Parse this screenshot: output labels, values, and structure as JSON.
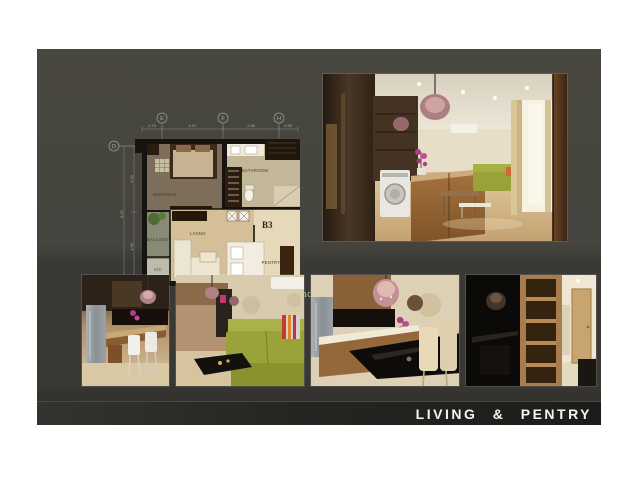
{
  "slide": {
    "footer_title": "LIVING  &  PENTRY"
  },
  "floorplan": {
    "caption": "RHYTHM Ratchada Condo",
    "unit_label": "B3",
    "grid_letters": {
      "top": [
        "E",
        "F",
        "H"
      ],
      "left": [
        "D",
        "C"
      ]
    },
    "dimensions": {
      "top": [
        "0.75",
        "3.10",
        "2.85",
        "0.95"
      ],
      "left": [
        "3.50",
        "1.95"
      ],
      "left_total": "6.45"
    },
    "rooms": {
      "bedroom": "BEDROOM",
      "bathroom": "BATHROOM",
      "living": "LIVING",
      "balcony": "BALCONY",
      "ac": "A/C",
      "pantry": "PENTRY"
    }
  },
  "photos": {
    "main": {
      "description": "Living room with wooden kitchen island, washing machine, crystal chandelier, green sofa, curtains and wood floor"
    },
    "thumbs": [
      {
        "description": "Kitchen bar with steel refrigerator, wooden counter and two white dining chairs"
      },
      {
        "description": "Living room with green sofa, striped cushions, black coffee table and air conditioner"
      },
      {
        "description": "Breakfast bar with chandelier, orchid flowers, black counter and cream chairs"
      },
      {
        "description": "Dark kitchen reflection, built-in wooden shelving and bright entrance hallway"
      }
    ]
  },
  "colors": {
    "panel_top": "#45443e",
    "panel_bottom": "#393834",
    "footer_bar": "#232220",
    "caption_text": "#b5b5a8",
    "footer_text": "#f4f4f2",
    "plan_wall": "#171310",
    "plan_wood_floor": "#d4bf98"
  }
}
